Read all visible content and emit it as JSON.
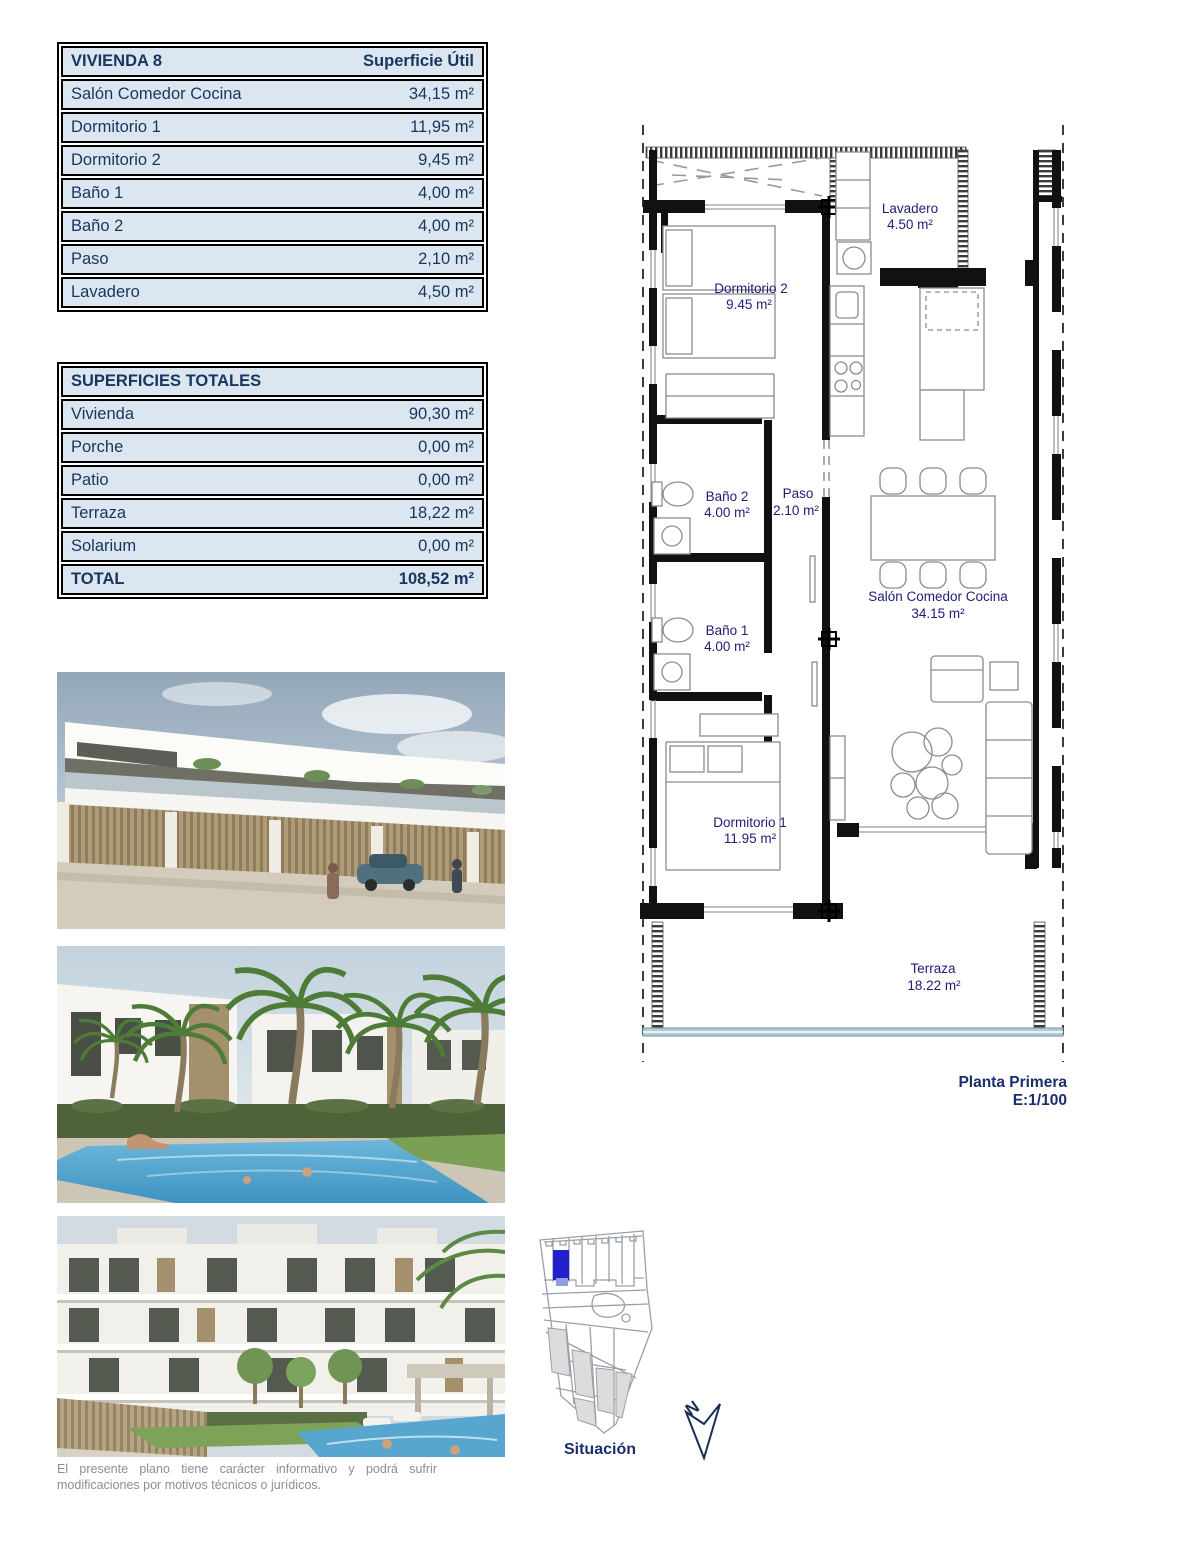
{
  "table_vivienda": {
    "title": "VIVIENDA 8",
    "header_right": "Superficie Útil",
    "rows": [
      {
        "label": "Salón Comedor Cocina",
        "value": "34,15 m²"
      },
      {
        "label": "Dormitorio 1",
        "value": "11,95 m²"
      },
      {
        "label": "Dormitorio 2",
        "value": "9,45 m²"
      },
      {
        "label": "Baño 1",
        "value": "4,00 m²"
      },
      {
        "label": "Baño 2",
        "value": "4,00 m²"
      },
      {
        "label": "Paso",
        "value": "2,10 m²"
      },
      {
        "label": "Lavadero",
        "value": "4,50 m²"
      }
    ]
  },
  "table_totales": {
    "title": "SUPERFICIES TOTALES",
    "rows": [
      {
        "label": "Vivienda",
        "value": "90,30 m²"
      },
      {
        "label": "Porche",
        "value": "0,00 m²"
      },
      {
        "label": "Patio",
        "value": "0,00 m²"
      },
      {
        "label": "Terraza",
        "value": "18,22 m²"
      },
      {
        "label": "Solarium",
        "value": "0,00 m²"
      }
    ],
    "total": {
      "label": "TOTAL",
      "value": "108,52 m²"
    }
  },
  "floorplan": {
    "rooms": [
      {
        "name": "Lavadero",
        "area": "4.50 m²"
      },
      {
        "name": "Dormitorio 2",
        "area": "9.45 m²"
      },
      {
        "name": "Baño 2",
        "area": "4.00 m²"
      },
      {
        "name": "Paso",
        "area": "2.10 m²"
      },
      {
        "name": "Salón Comedor Cocina",
        "area": "34.15 m²"
      },
      {
        "name": "Baño 1",
        "area": "4.00 m²"
      },
      {
        "name": "Dormitorio 1",
        "area": "11.95 m²"
      },
      {
        "name": "Terraza",
        "area": "18.22 m²"
      }
    ],
    "caption_line1": "Planta Primera",
    "caption_line2": "E:1/100"
  },
  "site_plan": {
    "label": "Situación",
    "north_label": "N"
  },
  "disclaimer": "El presente plano tiene carácter informativo y podrá sufrir modificaciones por motivos técnicos o jurídicos.",
  "colors": {
    "table_bg": "#dce6f1",
    "table_text": "#17365d",
    "plan_label": "#1d1d78",
    "highlight_unit": "#2020cc"
  }
}
